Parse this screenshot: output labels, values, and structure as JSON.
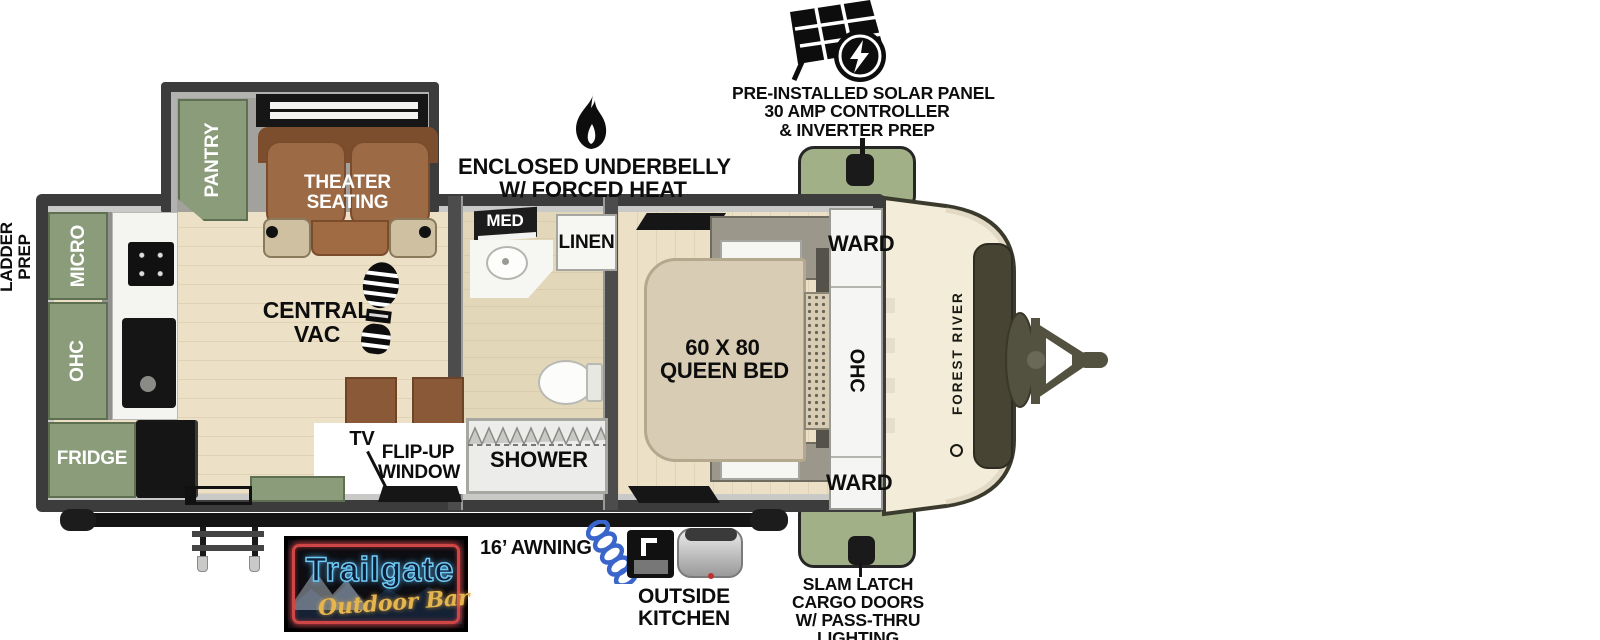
{
  "callouts": {
    "solar": {
      "line1": "PRE-INSTALLED SOLAR PANEL",
      "line2": "30 AMP CONTROLLER",
      "line3": "& INVERTER PREP"
    },
    "underbelly": {
      "line1": "ENCLOSED UNDERBELLY",
      "line2": "W/ FORCED HEAT"
    },
    "ladder": {
      "line1": "LADDER",
      "line2": "PREP"
    },
    "awning": "16’ AWNING",
    "outside_kitchen": {
      "line1": "OUTSIDE",
      "line2": "KITCHEN"
    },
    "slam_latch": {
      "line1": "SLAM LATCH",
      "line2": "CARGO DOORS",
      "line3": "W/ PASS-THRU",
      "line4": "LIGHTING"
    }
  },
  "labels": {
    "pantry": "PANTRY",
    "theater1": "THEATER",
    "theater2": "SEATING",
    "micro": "MICRO",
    "ohc_left": "OHC",
    "fridge": "FRIDGE",
    "central_vac1": "CENTRAL",
    "central_vac2": "VAC",
    "tv": "TV",
    "flipup1": "FLIP-UP",
    "flipup2": "WINDOW",
    "med": "MED",
    "linen": "LINEN",
    "shower": "SHOWER",
    "bed1": "60 X 80",
    "bed2": "QUEEN BED",
    "ward_top": "WARD",
    "ohc_bed": "OHC",
    "ward_bottom": "WARD",
    "brand": "FOREST RIVER"
  },
  "logo": {
    "name": "Trailgate",
    "sub": "Outdoor Bar"
  },
  "colors": {
    "cabinet_green": "#8a9c79",
    "cargo_door_green": "#a2b088",
    "floor_wood": "#ece1c6",
    "seat_brown": "#9c6a44",
    "bed_tan": "#d8ccb4",
    "wall_dark": "#3c3c3c",
    "cap_cream": "#f2ecd9",
    "neon_red": "#cf4646",
    "neon_blue": "#6fc9f2",
    "logo_gold": "#e6b54d",
    "hose_blue": "#3a66cc"
  }
}
